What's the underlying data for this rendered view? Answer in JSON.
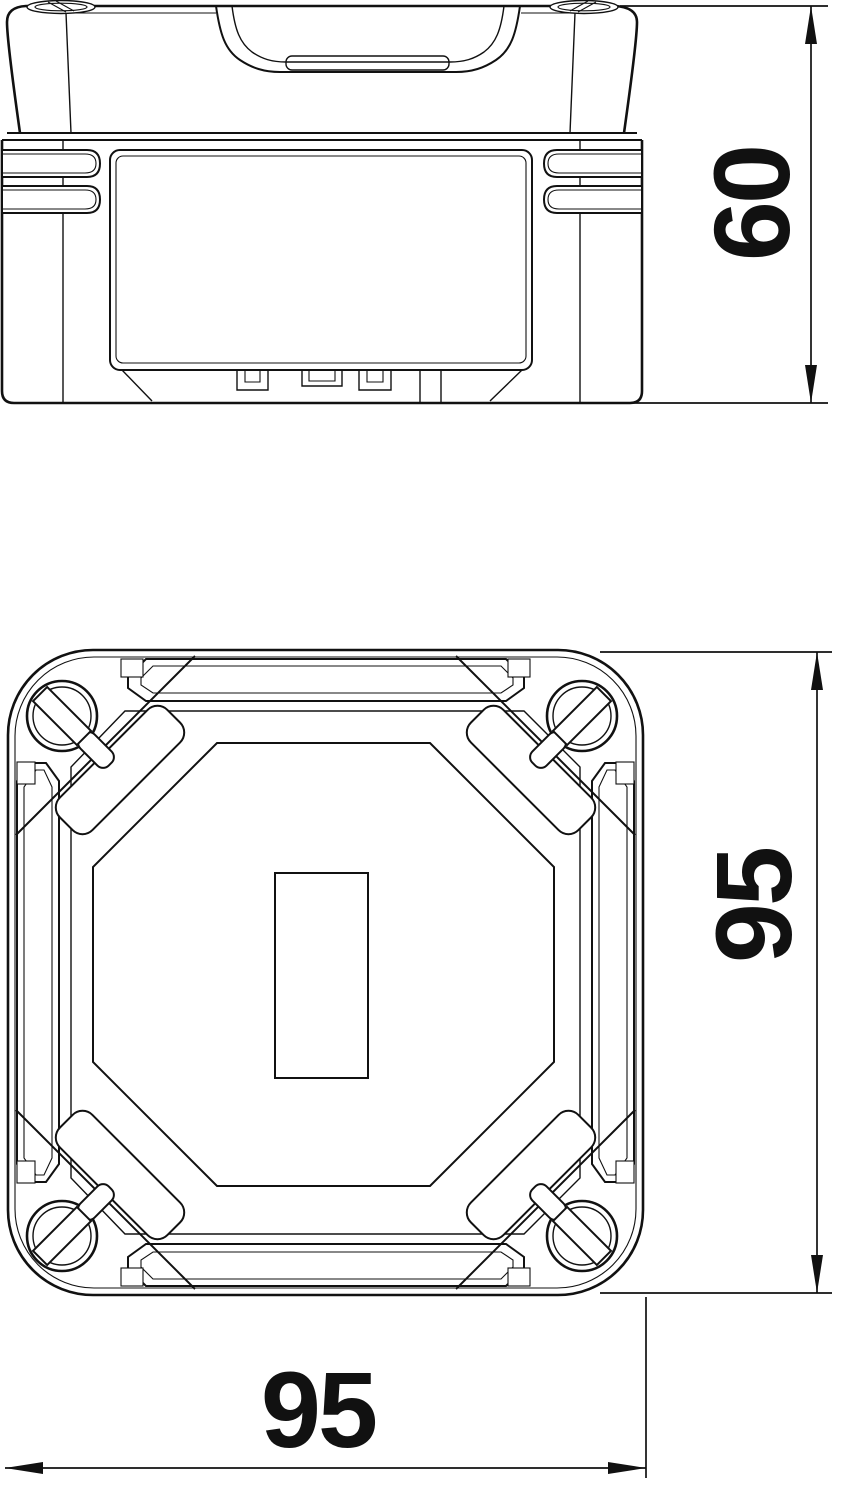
{
  "colors": {
    "background": "#ffffff",
    "ink": "#111111"
  },
  "dimensions": {
    "height": {
      "value": "60",
      "orientation": "vertical",
      "view": "side-elevation"
    },
    "depth": {
      "value": "95",
      "orientation": "vertical",
      "view": "bottom-view"
    },
    "width": {
      "value": "95",
      "orientation": "horizontal",
      "view": "bottom-view"
    }
  }
}
